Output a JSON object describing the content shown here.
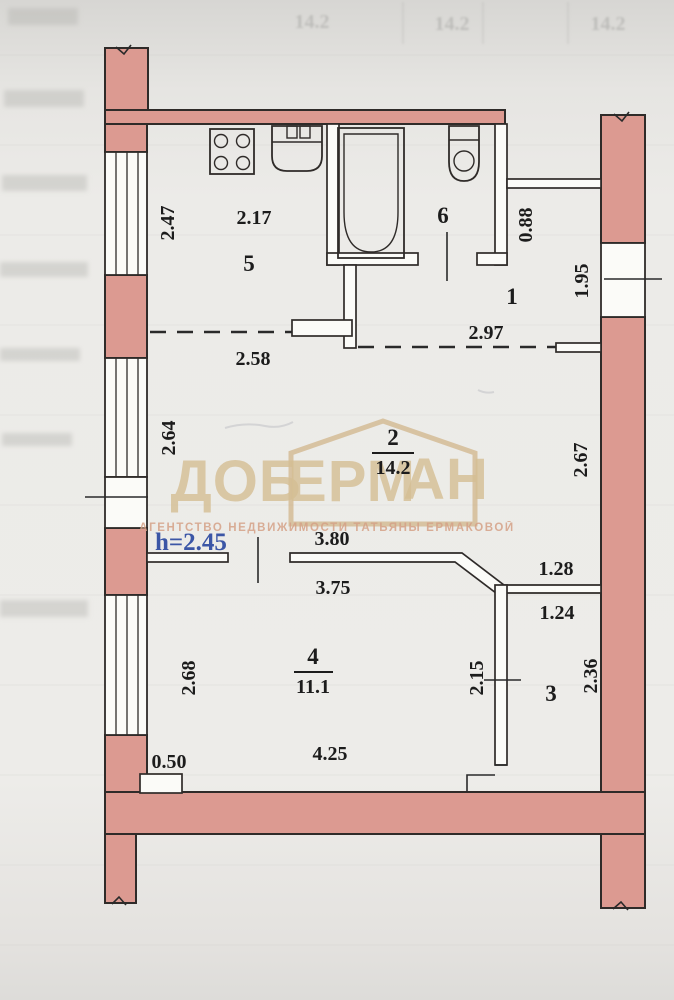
{
  "document_type": "apartment floor plan (scanned photo)",
  "watermark": {
    "brand_part_left": "ДОБ",
    "brand_part_mid": "ЕРМ",
    "brand_part_right": "АН",
    "subtitle": "АГЕНТСТВО НЕДВИЖИМОСТИ ТАТЬЯНЫ ЕРМАКОВОЙ",
    "brand_color": "#d5bf94",
    "house_icon": "house-outline-icon"
  },
  "ceiling_height_label": "h=2.45",
  "rooms": {
    "kitchen": {
      "number": "5",
      "width_label": "2.17",
      "left_dim": "2.47"
    },
    "bathroom": {
      "number": "6"
    },
    "hallway": {
      "number": "1",
      "width_label": "2.97",
      "niche_dim": "0.88",
      "window_dim": "1.95"
    },
    "living": {
      "number": "2",
      "area": "14.2",
      "top_dim": "2.58",
      "left_dim": "2.64",
      "right_dim": "2.67",
      "door_wall_top_dim": "3.80"
    },
    "bedroom": {
      "number": "4",
      "area": "11.1",
      "top_dim": "3.75",
      "left_dim": "2.68",
      "bottom_dim": "4.25",
      "nook_dim": "0.50",
      "closet_side_dim": "2.15"
    },
    "storage": {
      "number": "3",
      "top_dim": "1.24",
      "ledge_dim": "1.28",
      "right_dim": "2.36"
    }
  },
  "bleedthrough": {
    "values": [
      "14.2",
      "14.2",
      "14.2"
    ]
  },
  "colors": {
    "wall_fill": "#dc9a91",
    "outline": "#2f2b29",
    "paper": "#ecebe8",
    "dimension_text": "#1c1c1c",
    "height_text": "#3b56a6",
    "watermark_gold": "#c9a873"
  }
}
